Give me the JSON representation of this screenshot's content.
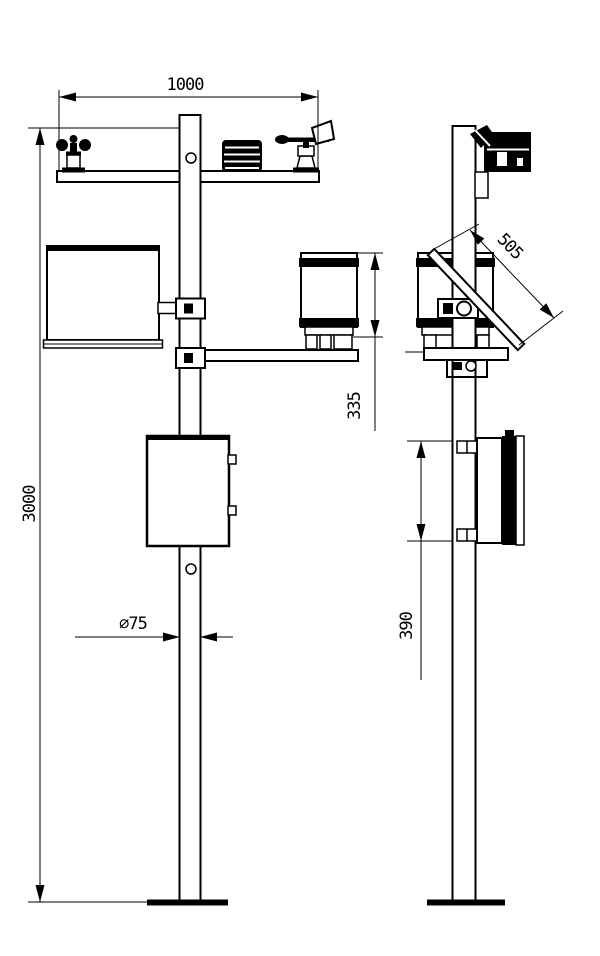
{
  "drawing": {
    "background_color": "#ffffff",
    "line_color": "#000000",
    "dimensions": {
      "crossarm_span": "1000",
      "pole_height": "3000",
      "pole_diameter": "∅75",
      "rain_gauge_mount_height": "335",
      "solar_panel_length": "505",
      "enclosure_height": "390"
    }
  }
}
